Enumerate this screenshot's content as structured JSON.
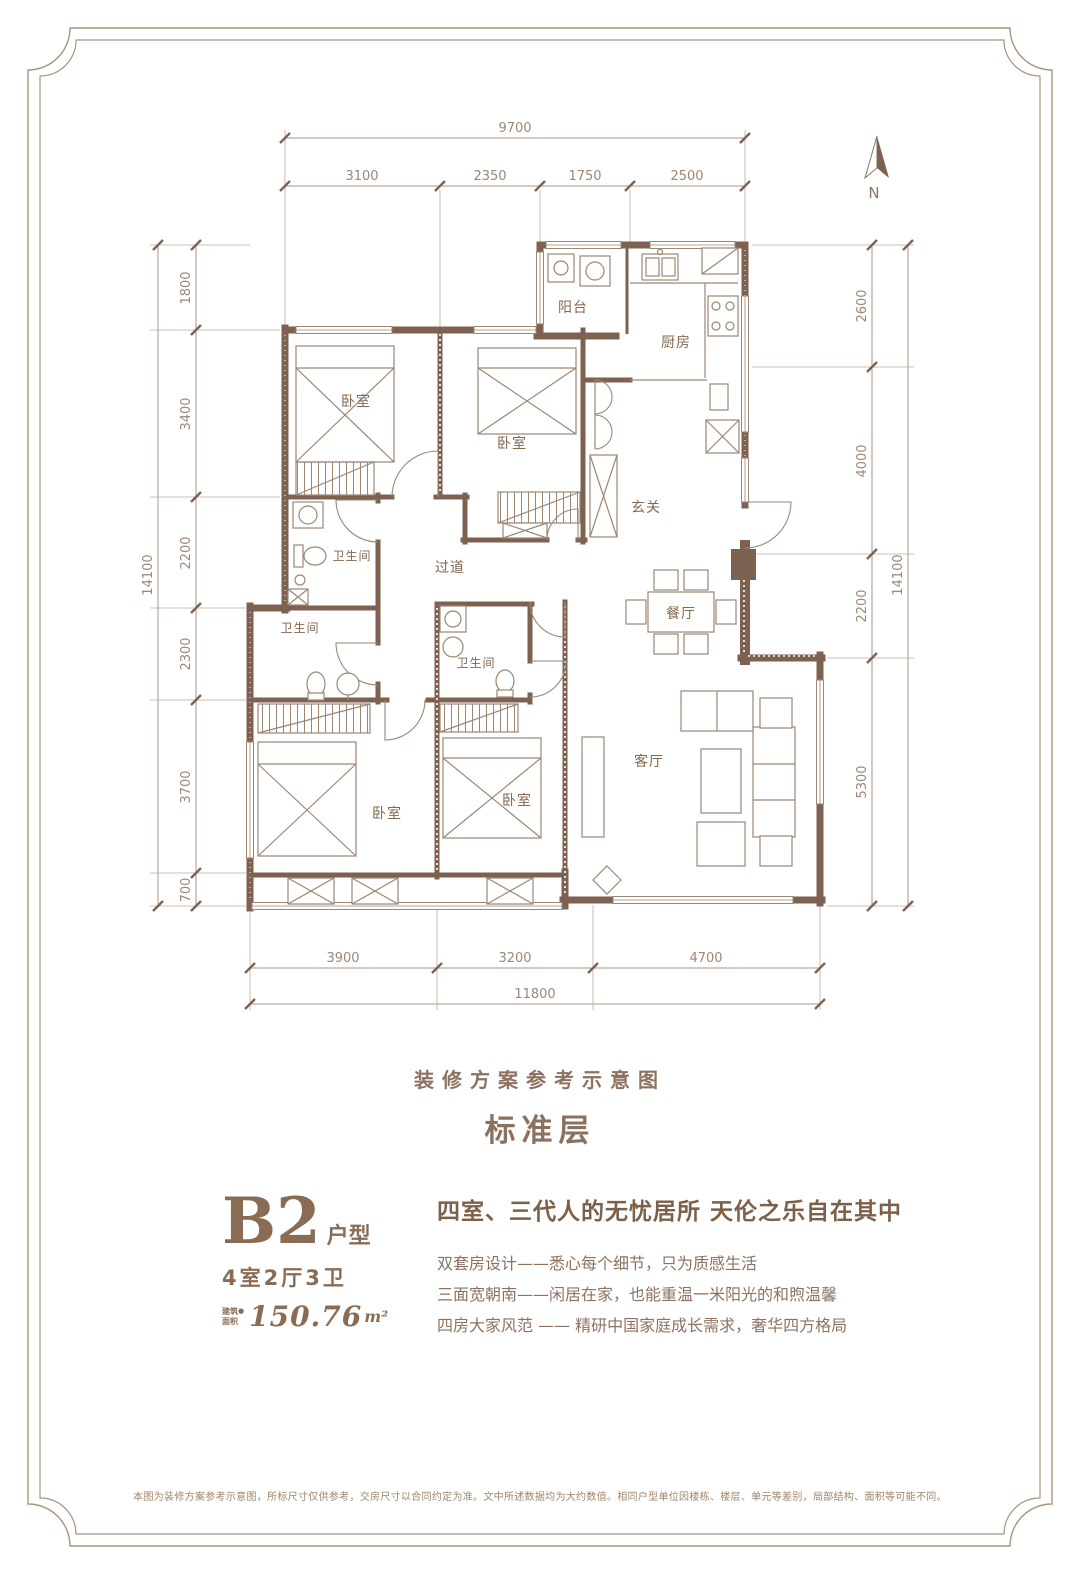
{
  "page": {
    "captions": {
      "scheme_note": "装修方案参考示意图",
      "floor_label": "标准层"
    },
    "disclaimer": "本图为装修方案参考示意图，所标尺寸仅供参考，交房尺寸以合同约定为准。文中所述数据均为大约数值。相同户型单位因楼栋、楼层、单元等差别，局部结构、面积等可能不同。"
  },
  "compass": {
    "label": "N"
  },
  "floor_plan": {
    "rooms": {
      "balcony": "阳台",
      "kitchen": "厨房",
      "foyer": "玄关",
      "corridor": "过道",
      "dining": "餐厅",
      "living": "客厅",
      "bedroom_1": "卧室",
      "bedroom_2": "卧室",
      "bedroom_3": "卧室",
      "bedroom_4": "卧室",
      "bath_1": "卫生间",
      "bath_2": "卫生间",
      "bath_3": "卫生间"
    }
  },
  "dimensions": {
    "top": {
      "total": "9700",
      "segments": [
        "3100",
        "2350",
        "1750",
        "2500"
      ]
    },
    "left": {
      "total": "14100",
      "segments": [
        "1800",
        "3400",
        "2200",
        "2300",
        "3700",
        "700"
      ]
    },
    "right": {
      "total": "14100",
      "segments": [
        "2600",
        "4000",
        "2200",
        "5300"
      ]
    },
    "bottom": {
      "total": "11800",
      "segments": [
        "3900",
        "3200",
        "4700"
      ]
    }
  },
  "unit": {
    "code": "B2",
    "code_suffix": "户型",
    "layout": "4室2厅3卫",
    "area_label_line1": "建筑",
    "area_label_line2": "面积",
    "area_label_dot": "●",
    "area_value": "150.76",
    "area_unit": "m²"
  },
  "selling_points": {
    "headline": "四室、三代人的无忧居所 天伦之乐自在其中",
    "items": [
      "双套房设计——悉心每个细节，只为质感生活",
      "三面宽朝南——闲居在家，也能重温一米阳光的和煦温馨",
      "四房大家风范 —— 精研中国家庭成长需求，奢华四方格局"
    ]
  },
  "colors": {
    "wall": "#7d6252",
    "furniture_line": "#9d8672",
    "dimension": "#9c8776",
    "room_label": "#85674f",
    "heading": "#7d6048",
    "body_text": "#8d7260",
    "border": "#a8937d",
    "background": "#ffffff"
  }
}
